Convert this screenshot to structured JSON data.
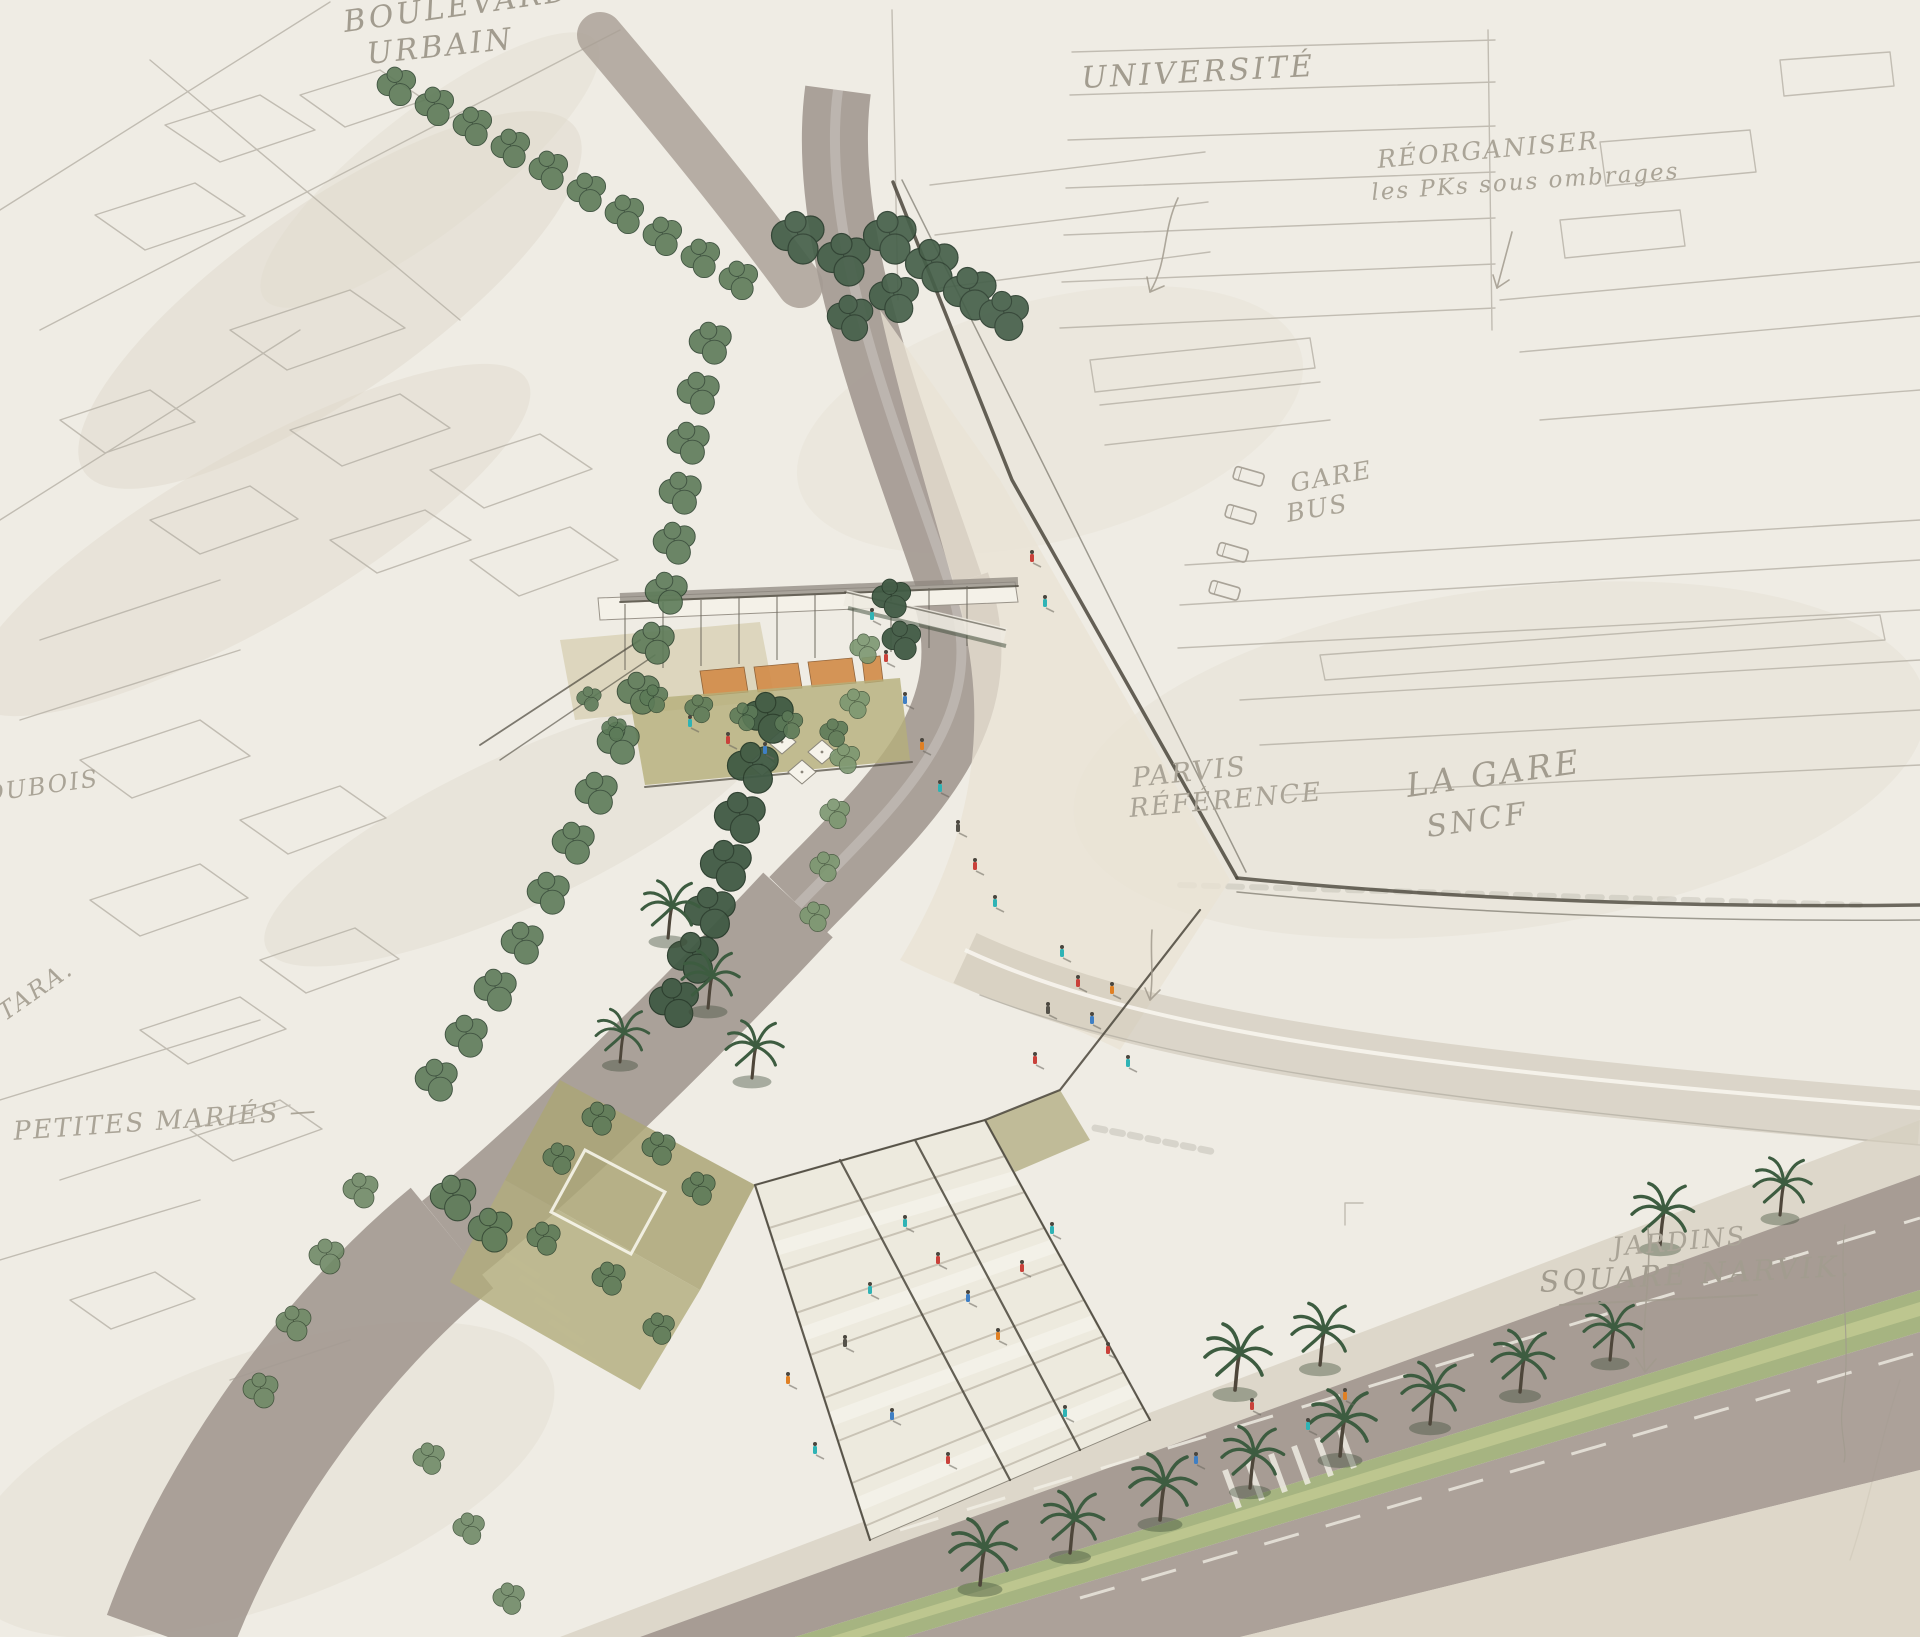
{
  "document": {
    "title": "Urban design concept sketch — station forecourt and boulevard",
    "medium": "pencil and marker aerial perspective sketch on paper"
  },
  "palette": {
    "paper": "#efece4",
    "pencil_gray": "#b6b1a6",
    "ink_dark": "#4b473c",
    "road_gray": "#a49a92",
    "tree_dark_green": "#46604a",
    "tree_mid_green": "#5d7a58",
    "tree_light_green": "#7c9770",
    "median_green": "#9dae76",
    "terrace_olive": "#b5af7b",
    "awning_orange": "#d28c4a",
    "steps_white": "#f3f0e8",
    "person_teal": "#2fb3b5",
    "person_red": "#c9413a",
    "person_blue": "#3f7fc4",
    "person_orange": "#e08024"
  },
  "annotations": {
    "boulevard_urbain": {
      "line1": "BOULEVARD",
      "line2": "URBAIN"
    },
    "universite": {
      "line1": "UNIVERSITÉ"
    },
    "reorganiser": {
      "line1": "RÉORGANISER",
      "line2": "les PKs sous ombrages"
    },
    "gare_bus": {
      "line1": "GARE",
      "line2": "BUS"
    },
    "parvis_reference": {
      "line1": "PARVIS",
      "line2": "RÉFÉRENCE"
    },
    "la_gare_sncf": {
      "line1": "LA GARE",
      "line2": "SNCF"
    },
    "jardins_square_narvik": {
      "line1": "JARDINS",
      "line2": "SQUARE NARVIK."
    },
    "dubois": {
      "line1": "DUBOIS"
    },
    "ttara": {
      "line1": "TTARA."
    },
    "petites_maries": {
      "line1": "S PETITES MARIÉS —"
    }
  }
}
